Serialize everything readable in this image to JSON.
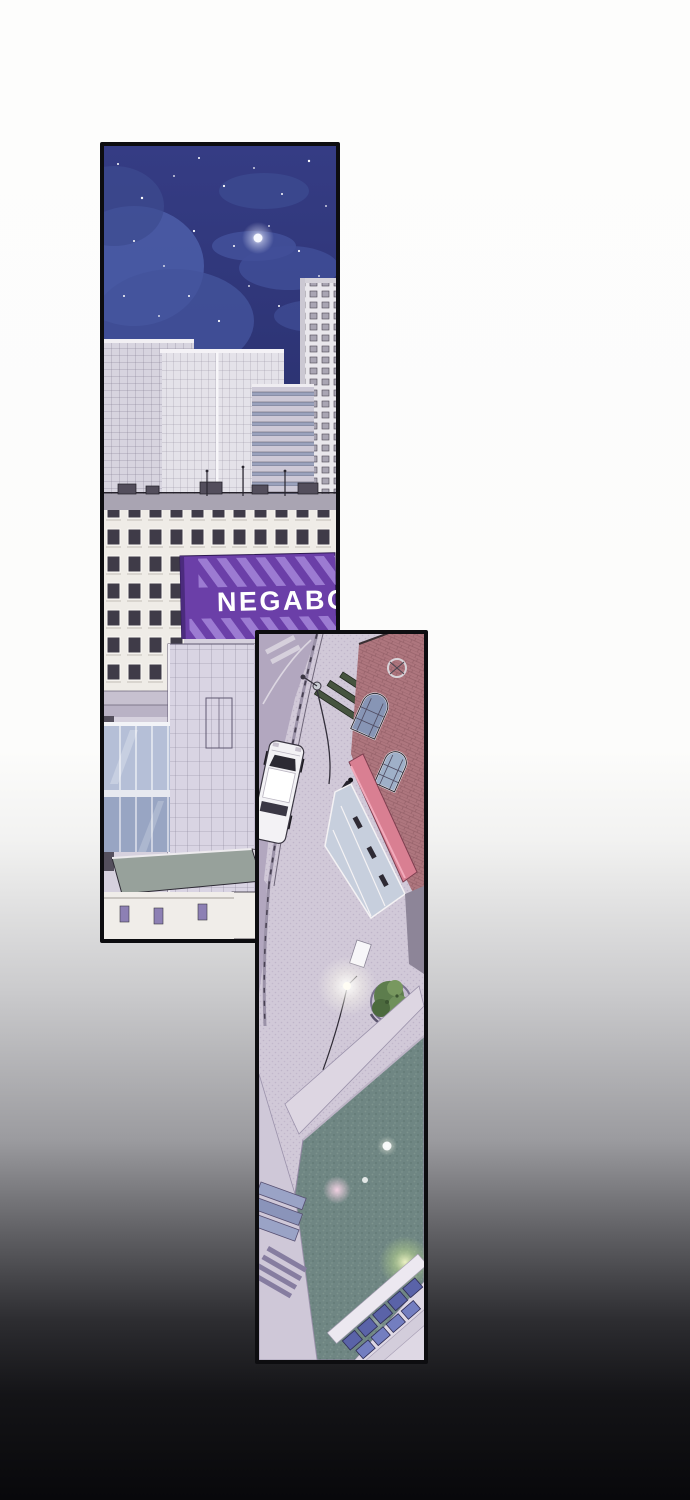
{
  "scene": {
    "type": "webtoon-comic-page",
    "panel_count": 2,
    "panels": [
      {
        "id": "night-cityscape",
        "description": "night sky with stars, moon and clouds over glass skyscrapers, an apartment block with a striped purple signboard, and lower city buildings"
      },
      {
        "id": "street-aerial-view",
        "description": "bird's-eye view of a curved street with a white car, benches, street lamps, a red brick shop building with pink awning, a tree planter, a dark canal and rooftops with blue skylights"
      }
    ]
  },
  "sign": {
    "text": "NEGABO"
  },
  "colors": {
    "page_top": "#fdfdfc",
    "page_bottom": "#08080b",
    "panel_border": "#0d0d10",
    "sky": "#343b82",
    "sign": "#6b3fa8",
    "sign_stripe": "#9c7bd2",
    "sign_text": "#ffffff",
    "brick": "#ae767e",
    "awning": "#d97f92",
    "water": "#6f8683",
    "tree": "#5d7d4d",
    "moon": "#f6f8ff",
    "lamp_glow": "#fffdf4"
  }
}
